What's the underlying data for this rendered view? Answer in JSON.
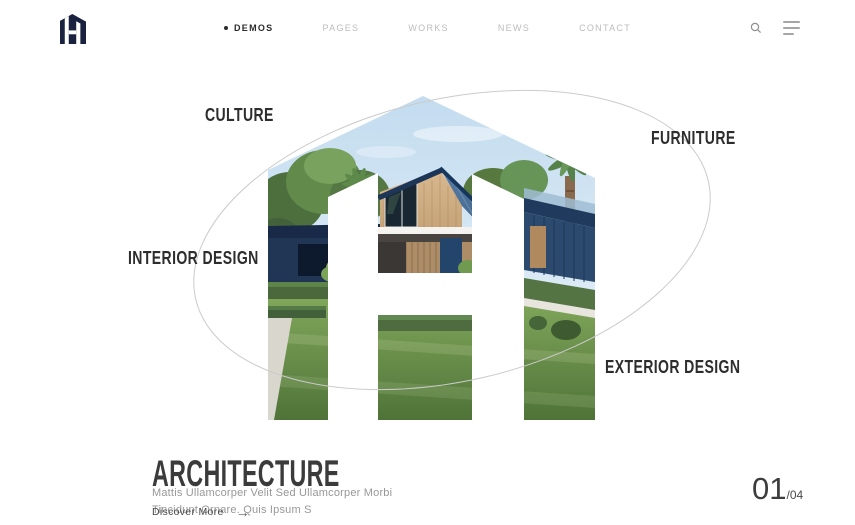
{
  "header": {
    "nav_items": [
      {
        "label": "DEMOS",
        "active": true
      },
      {
        "label": "PAGES",
        "active": false
      },
      {
        "label": "WORKS",
        "active": false
      },
      {
        "label": "NEWS",
        "active": false
      },
      {
        "label": "CONTACT",
        "active": false
      }
    ],
    "icons": {
      "search": "magnifier-icon",
      "menu": "hamburger-icon"
    }
  },
  "hero": {
    "category_labels": {
      "top_left": "CULTURE",
      "top_right": "FURNITURE",
      "left": "INTERIOR DESIGN",
      "bottom_right": "EXTERIOR DESIGN"
    },
    "title": "ARCHITECTURE",
    "description": "Mattis Ullamcorper Velit Sed Ullamcorper Morbi Tincidunt Ornare. Quis Ipsum S",
    "cta_label": "Discover More",
    "cta_arrow": "→",
    "pagination": {
      "current": "01",
      "total": "/04"
    }
  },
  "colors": {
    "logo_navy": "#1a2240",
    "label_text": "#2d2d2d",
    "muted_text": "#989898",
    "ellipse_stroke": "#cbcbcb",
    "roof_blue": "#35587e",
    "grass_green": "#4f7338",
    "sky_blue": "#c3dcef"
  }
}
